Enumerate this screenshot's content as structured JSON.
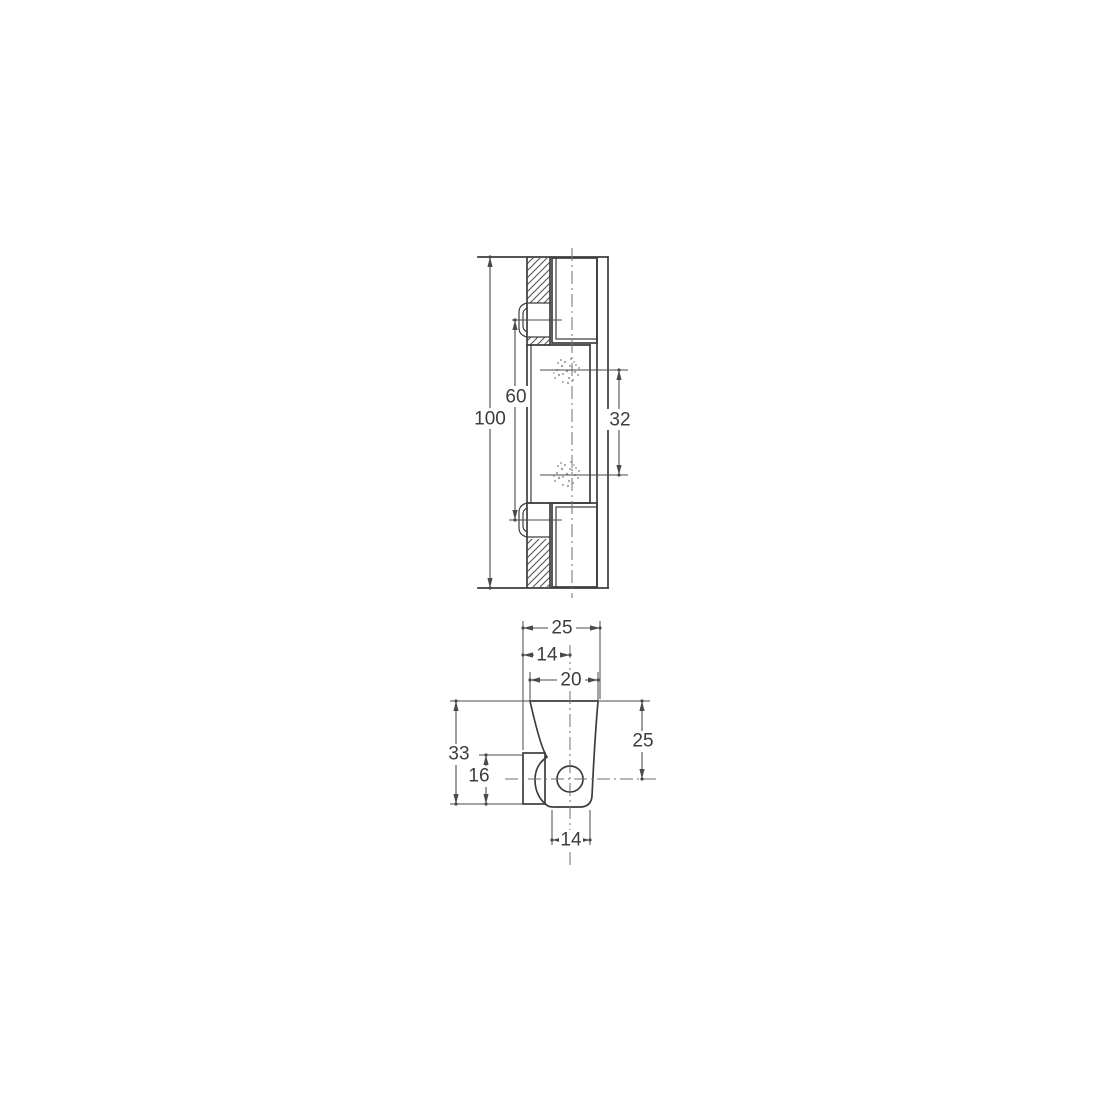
{
  "title": "Technical drawing of hinge with two dimensioned views",
  "colors": {
    "background": "#ffffff",
    "line": "#3d3d3d",
    "dimension": "#4a4a4a",
    "centerline": "#6f6f6f",
    "stipple": "#a0a0a0"
  },
  "front_view": {
    "dims": {
      "overall_height": "100",
      "fastener_spacing": "60",
      "spot_spacing": "32"
    }
  },
  "top_view": {
    "dims": {
      "overall_width": "25",
      "edge_to_hole_center": "14",
      "tongue_width": "20",
      "overall_depth": "33",
      "block_depth": "16",
      "top_to_hole_center": "25",
      "knuckle_width": "14"
    }
  }
}
